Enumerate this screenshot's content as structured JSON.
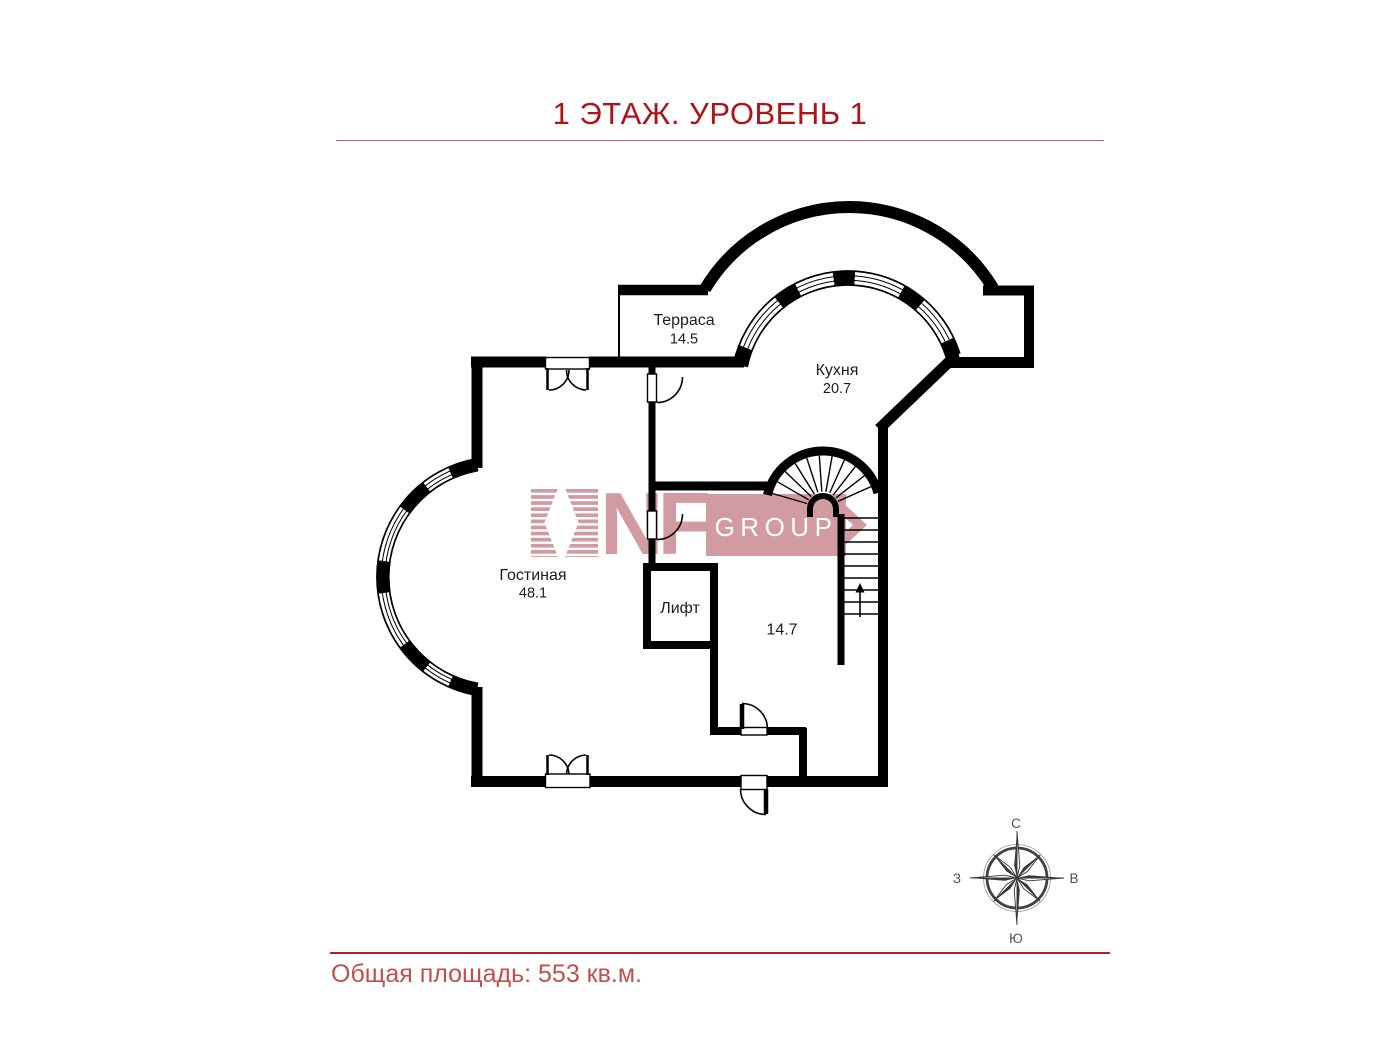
{
  "header": {
    "title": "1 ЭТАЖ. УРОВЕНЬ 1"
  },
  "footer": {
    "total_area": "Общая площадь: 553 кв.м."
  },
  "rooms": {
    "terrace": {
      "name": "Терраса",
      "area": "14.5"
    },
    "kitchen": {
      "name": "Кухня",
      "area": "20.7"
    },
    "living": {
      "name": "Гостиная",
      "area": "48.1"
    },
    "elevator": {
      "name": "Лифт"
    },
    "hall": {
      "area": "14.7"
    }
  },
  "compass": {
    "north": "С",
    "east": "В",
    "south": "Ю",
    "west": "З"
  },
  "watermark": {
    "brand": "NF",
    "suffix": "GROUP"
  },
  "colors": {
    "title": "#b01218",
    "footer_text": "#c0504d",
    "rule_top": "#c0605e",
    "rule_bottom": "#b32025",
    "walls": "#000000",
    "watermark_pink": "#d29aa1",
    "compass_gray": "#424242"
  }
}
